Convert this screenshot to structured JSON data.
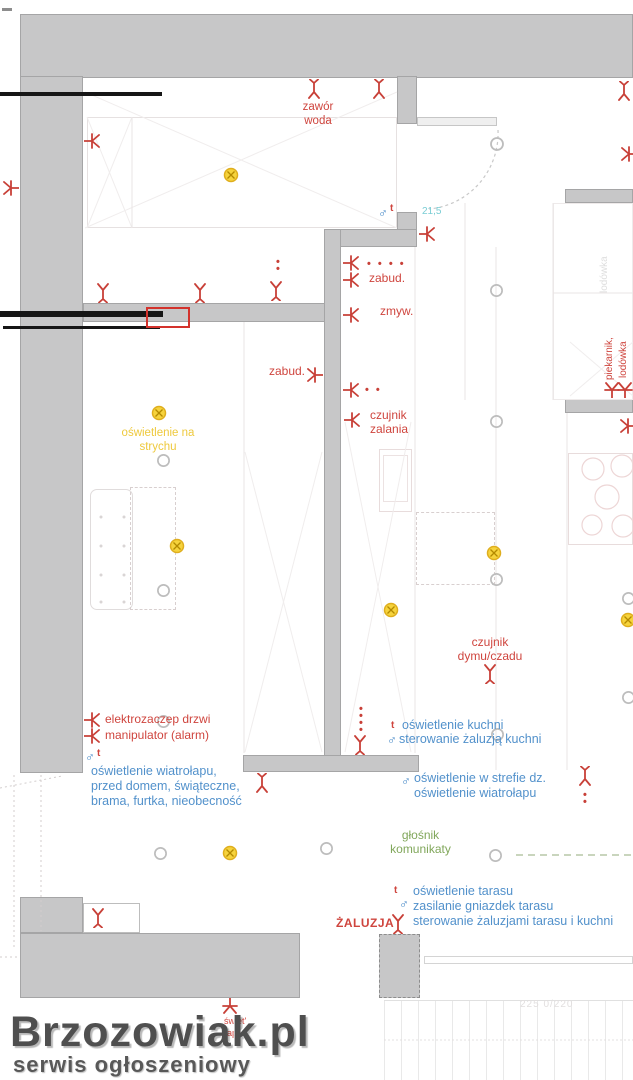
{
  "labels": {
    "zawor_woda": "zawór\nwoda",
    "dim_door": "21,5",
    "sockets4": "• • • •",
    "zabud_1": "zabud.",
    "zmyw": "zmyw.",
    "zabud_2": "zabud.",
    "sockets2": "• •",
    "czujnik_zalania": "czujnik\nzalania",
    "osw_strych": "oświetlenie na\nstrychu",
    "piekarnik": "piekarnik,",
    "lodowka_red": "lodówka",
    "lodowka_gray": "lodówka",
    "czujnik_dymu": "czujnik\ndymu/czadu",
    "elektrozaczep": "elektrozaczep drzwi",
    "manipulator": "manipulator (alarm)",
    "male": "♂",
    "t": "t",
    "wiatrolap": "oświetlenie wiatrołapu,\nprzed domem, świąteczne,\nbrama, furtka, nieobecność",
    "osw_kuchni": "oświetlenie kuchni",
    "ster_zaluzja_kuchni": "sterowanie żaluzją kuchni",
    "osw_strefa": "oświetlenie w strefie dz.\noświetlenie wiatrołapu",
    "glosnik": "głośnik\nkomunikaty",
    "taras": "oświetlenie tarasu\nzasilanie gniazdek tarasu\nsterowanie żaluzjami tarasu i kuchni",
    "zaluzja": "ŻALUZJA",
    "dim_taras": "225 0/220",
    "frag1": "świet'",
    "frag2": "ape",
    "dots2v": "•\n•",
    "dots4v": "•\n•\n•\n•"
  },
  "watermark": {
    "title": "Brzozowiak.pl",
    "subtitle": "serwis ogłoszeniowy"
  },
  "colors": {
    "wall": "#c7c7c8",
    "red": "#cf453e",
    "blue": "#5291cb",
    "teal": "#79cdd4",
    "yellow": "#eec93d",
    "green": "#81a75b",
    "lamp_gray": "#bdbdbd",
    "watermark": "#4f4f4f"
  }
}
